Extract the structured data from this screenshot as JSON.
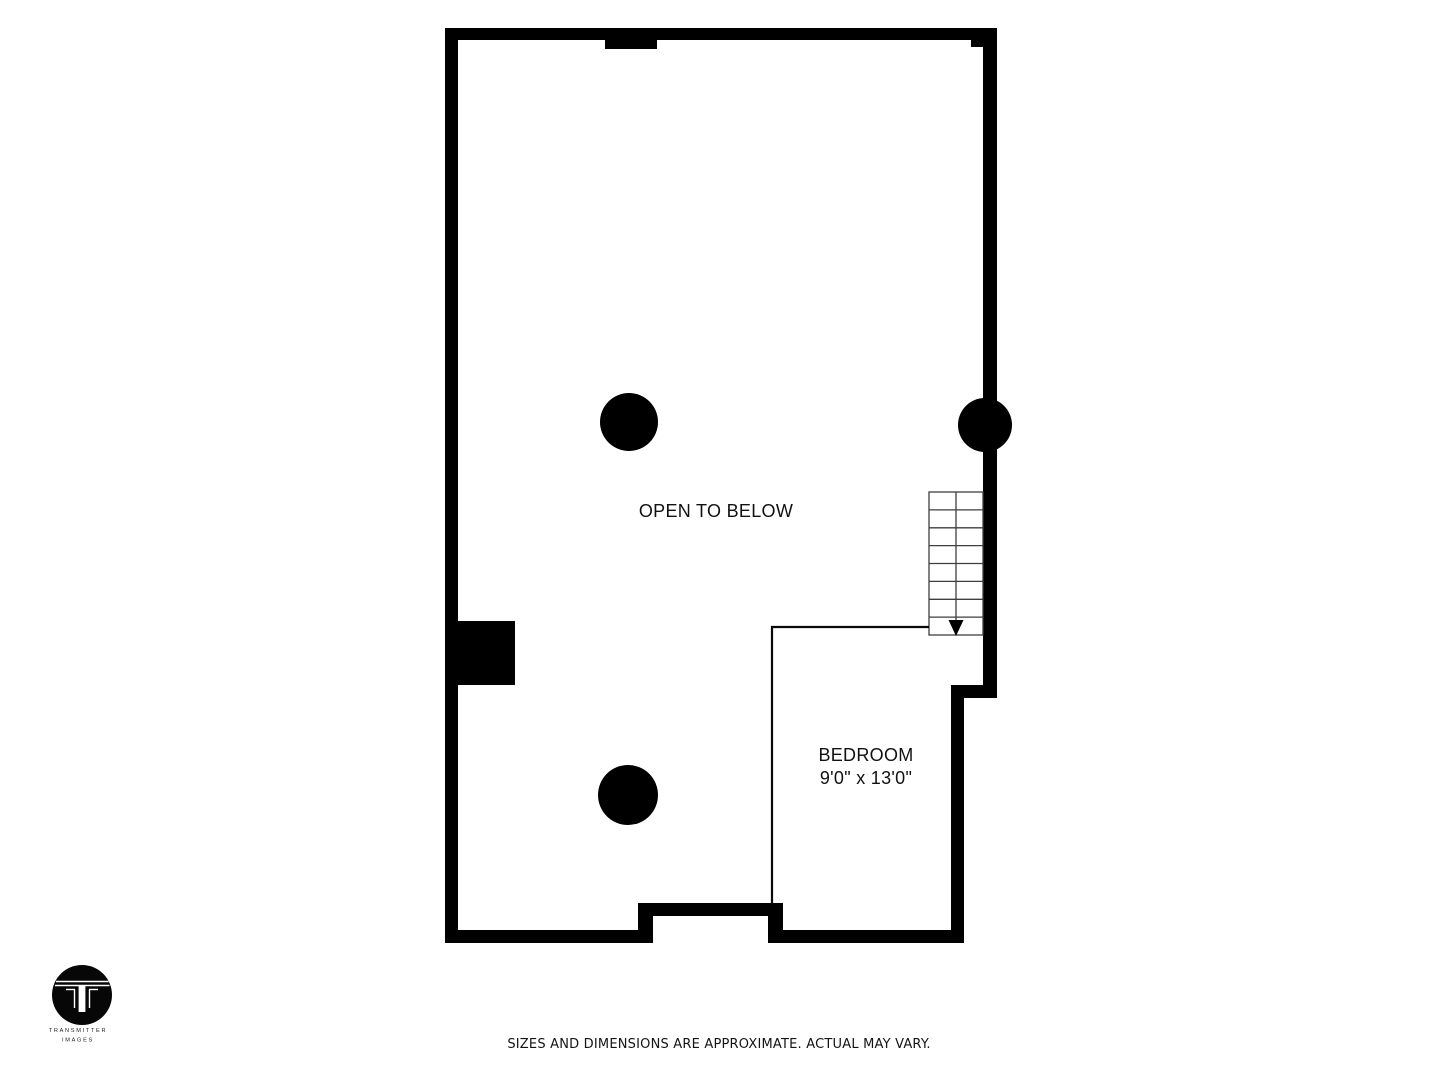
{
  "floor_plan": {
    "open_area_label": "OPEN TO BELOW",
    "bedroom": {
      "name": "BEDROOM",
      "dimensions": "9'0\" x 13'0\""
    },
    "stairs": {
      "steps": 8,
      "direction": "down"
    },
    "colors": {
      "wall": "#000000",
      "stair_line": "#3e3e3e",
      "label_text": "#111111"
    }
  },
  "footer": {
    "disclaimer": "SIZES AND DIMENSIONS ARE APPROXIMATE. ACTUAL MAY VARY."
  },
  "logo": {
    "name": "TRANSMITTER",
    "tagline": "IMAGES"
  }
}
